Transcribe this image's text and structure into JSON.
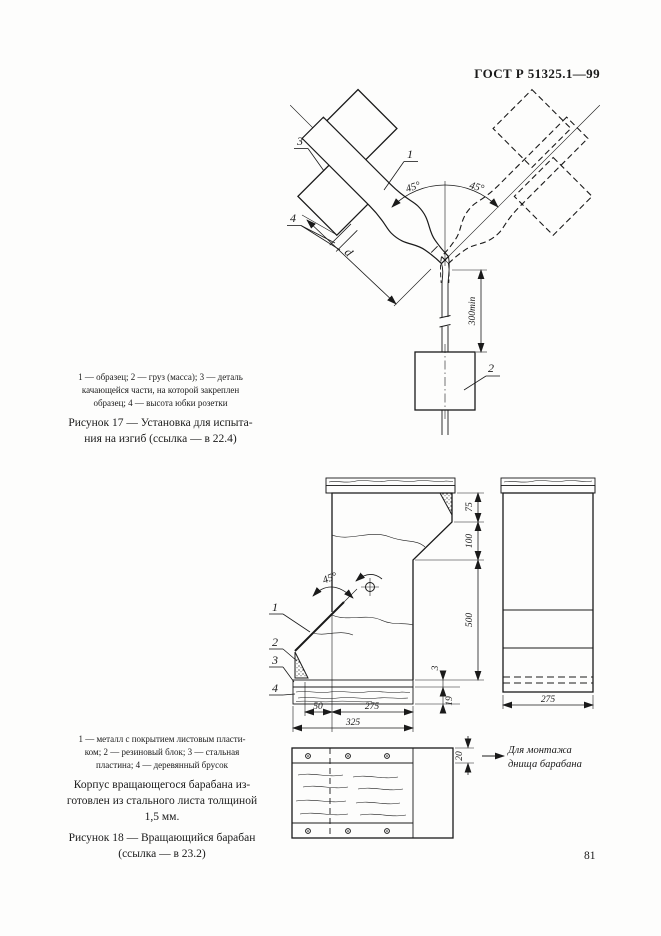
{
  "page": {
    "header_title": "ГОСТ Р 51325.1—99",
    "page_number": "81"
  },
  "figure17": {
    "legend_lines": [
      "1 — образец; 2 — груз (масса); 3 — деталь",
      "качающейся части, на которой закреплен",
      "образец; 4 — высота юбки розетки"
    ],
    "caption_lines": [
      "Рисунок 17 — Установка для испыта-",
      "ния на изгиб (ссылка — в 22.4)"
    ],
    "callouts": {
      "sample": "1",
      "weight": "2",
      "swing_part": "3",
      "skirt_height": "4"
    },
    "dims": {
      "angle_left": "45°",
      "angle_right": "45°",
      "skirt_dim": "d",
      "cord_length": "300min"
    }
  },
  "figure18": {
    "legend_lines": [
      "1 — металл с покрытием листовым пласти-",
      "ком; 2 — резиновый блок; 3 — стальная",
      "пластина; 4 — деревянный брусок"
    ],
    "note_lines": [
      "Корпус вращающегося барабана из-",
      "готовлен из стального листа толщиной",
      "1,5 мм."
    ],
    "caption_lines": [
      "Рисунок 18 — Вращающийся барабан",
      "(ссылка — в 23.2)"
    ],
    "callouts": {
      "coated_metal": "1",
      "rubber_block": "2",
      "steel_plate": "3",
      "wooden_block": "4"
    },
    "dims": {
      "angle": "45°",
      "h75": "75",
      "h100": "100",
      "h500": "500",
      "t3": "3",
      "t19": "19",
      "w50": "50",
      "w275": "275",
      "w325": "325",
      "side_w275": "275",
      "strip20": "20"
    },
    "note_arrow_lines": [
      "Для монтажа",
      "днища барабана"
    ]
  }
}
